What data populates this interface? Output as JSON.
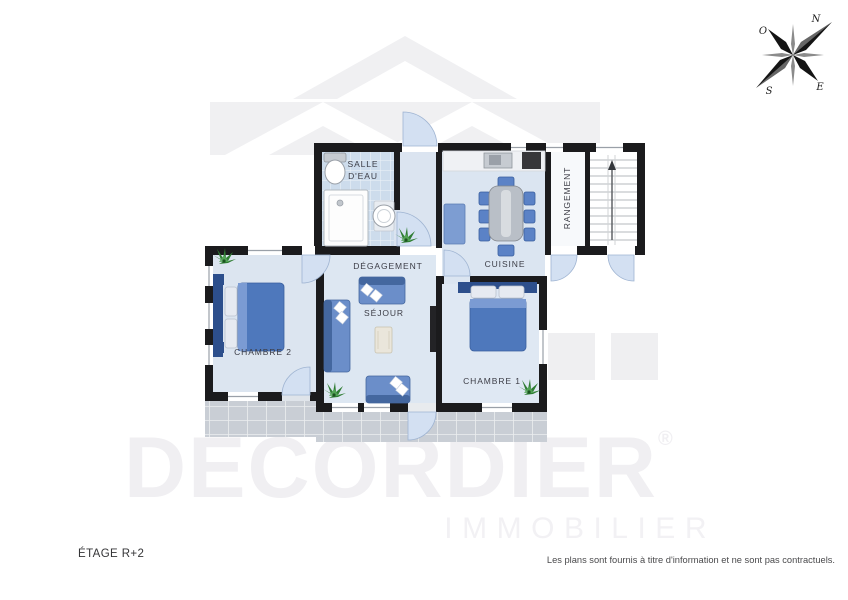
{
  "footer": {
    "floor_label": "ÉTAGE R+2",
    "disclaimer": "Les plans sont fournis à titre d'information et ne sont pas contractuels."
  },
  "watermark": {
    "brand": "DECORDIER",
    "registered": "®",
    "subbrand": "IMMOBILIER"
  },
  "compass": {
    "north": "N",
    "east": "E",
    "south": "S",
    "west": "O"
  },
  "rooms": {
    "salle_deau": "SALLE D'EAU",
    "degagement": "DÉGAGEMENT",
    "cuisine": "CUISINE",
    "rangement": "RANGEMENT",
    "chambre_2": "CHAMBRE 2",
    "sejour": "SÉJOUR",
    "chambre_1": "CHAMBRE 1"
  },
  "colors": {
    "wall": "#1b1b1d",
    "floor_blue": "#dde6f1",
    "tile_blue": "#cddcec",
    "furniture_blue": "#4e78bc",
    "headboard_navy": "#2d4f8c",
    "terrace_gray": "#c9ced5",
    "door_arc_blue": "#d3e0f2",
    "watermark_gray": "#f0eff2",
    "plant_green": "#2f7d33"
  }
}
